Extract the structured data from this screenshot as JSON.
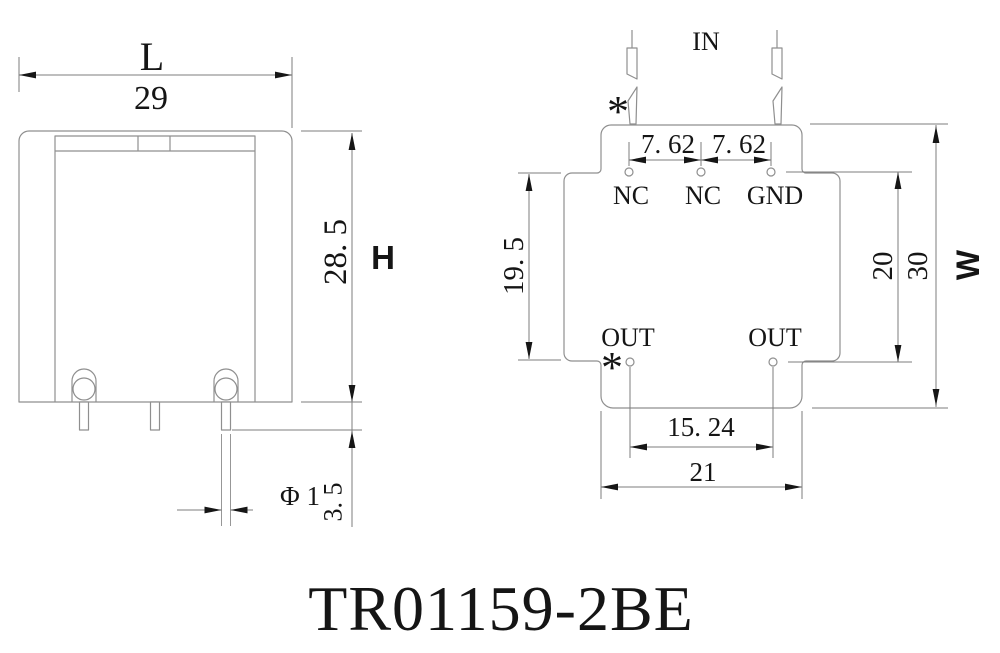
{
  "title": "TR01159-2BE",
  "colors": {
    "line": "#7d7d7d",
    "outline": "#8f8f8f",
    "text": "#151515",
    "arrow": "#161616",
    "background": "#ffffff"
  },
  "front_view": {
    "width_letter": "L",
    "width_mm": "29",
    "height_letter": "H",
    "height_mm": "28. 5",
    "pin_protrusion_mm": "3. 5",
    "pin_diameter": "Φ 1"
  },
  "pin_view": {
    "input_label": "IN",
    "polarity_marker": "*",
    "top_pitches_mm": [
      "7. 62",
      "7. 62"
    ],
    "top_pin_labels": [
      "NC",
      "NC",
      "GND"
    ],
    "bottom_pin_labels": [
      "OUT",
      "OUT"
    ],
    "row_spacing_mm": "19. 5",
    "bottom_pitch_mm": "15. 24",
    "flange_width_mm": "21",
    "pin_span_mm": "20",
    "body_width_mm": "30",
    "width_letter": "W"
  }
}
